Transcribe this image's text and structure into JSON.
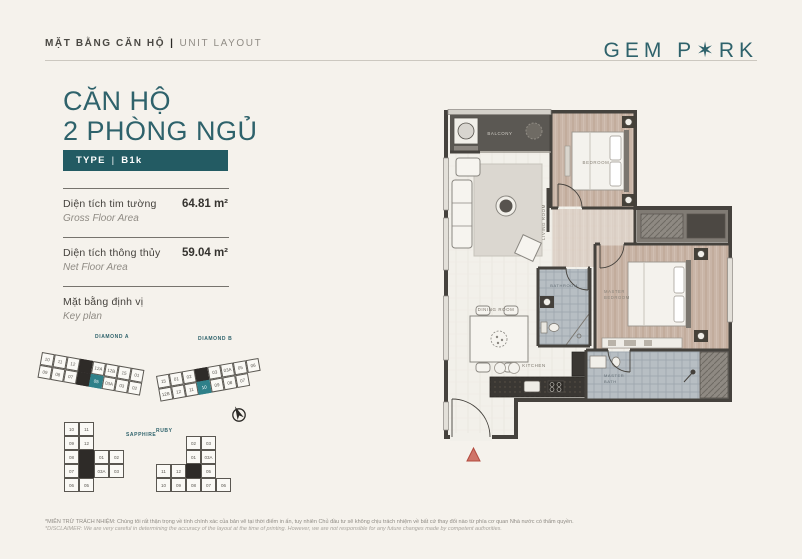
{
  "colors": {
    "accent": "#2e626b",
    "badge": "#235b63",
    "highlight": "#2f8089",
    "wall": "#45423d",
    "wood": "#c9b5a7",
    "tile": "#b7bec3",
    "entry_marker": "#cf7468"
  },
  "header": {
    "title_vi": "MẶT BẰNG CĂN HỘ",
    "sep": "|",
    "title_en": "UNIT LAYOUT",
    "logo_part1": "GEM P",
    "logo_star": "✶",
    "logo_part2": "RK"
  },
  "unit": {
    "title_line1": "CĂN HỘ",
    "title_line2": "2 PHÒNG NGỦ",
    "type_label": "TYPE",
    "type_sep": "|",
    "type_value": "B1k"
  },
  "areas": [
    {
      "label_vi": "Diện tích tim tường",
      "label_en": "Gross Floor Area",
      "value": "64.81 m²"
    },
    {
      "label_vi": "Diện tích thông thủy",
      "label_en": "Net Floor Area",
      "value": "59.04 m²"
    }
  ],
  "keyplan": {
    "label_vi": "Mặt bằng định vị",
    "label_en": "Key plan",
    "diamond_a": {
      "name": "DIAMOND A",
      "top": [
        "10",
        "11",
        "12",
        {
          "t": "",
          "c": "dk"
        },
        "12A",
        "12B",
        "15",
        "01"
      ],
      "bottom": [
        "09",
        "08",
        "07",
        {
          "t": "",
          "c": "dk"
        },
        {
          "t": "05",
          "c": "hl"
        },
        "03A",
        "03",
        "02"
      ]
    },
    "diamond_b": {
      "name": "DIAMOND B",
      "top": [
        "15",
        "01",
        "02",
        {
          "t": "",
          "c": "dk"
        },
        "03",
        "03A",
        "05",
        "06"
      ],
      "bottom": [
        "12B",
        "12",
        "11",
        {
          "t": "10",
          "c": "hl"
        },
        "09",
        "08",
        "07",
        {
          "t": "",
          "c": "empty"
        }
      ]
    },
    "sapphire": {
      "name": "SAPPHIRE",
      "cells": [
        "10",
        "11",
        {
          "t": "",
          "c": "empty"
        },
        {
          "t": "",
          "c": "empty"
        },
        "09",
        "12",
        {
          "t": "",
          "c": "empty"
        },
        {
          "t": "",
          "c": "empty"
        },
        "08",
        {
          "t": "",
          "c": "dk"
        },
        "01",
        "02",
        "07",
        {
          "t": "",
          "c": "dk"
        },
        "03A",
        "03",
        "06",
        "05",
        {
          "t": "",
          "c": "empty"
        },
        {
          "t": "",
          "c": "empty"
        }
      ]
    },
    "ruby": {
      "name": "RUBY",
      "cells": [
        {
          "t": "",
          "c": "empty"
        },
        {
          "t": "",
          "c": "empty"
        },
        "02",
        "03",
        {
          "t": "",
          "c": "empty"
        },
        {
          "t": "",
          "c": "empty"
        },
        {
          "t": "",
          "c": "empty"
        },
        "01",
        "03A",
        {
          "t": "",
          "c": "empty"
        },
        "11",
        "12",
        {
          "t": "",
          "c": "dk"
        },
        "05",
        {
          "t": "",
          "c": "empty"
        },
        "10",
        "09",
        "08",
        "07",
        "06"
      ]
    }
  },
  "floorplan": {
    "rooms": {
      "balcony": "BALCONY",
      "living": "LIVING ROOM",
      "bedroom": "BEDROOM",
      "dining": "DINING ROOM",
      "bathroom": "BATHROOM",
      "kitchen": "KITCHEN",
      "master_l1": "MASTER",
      "master_l2": "BEDROOM",
      "mbath_l1": "MASTER",
      "mbath_l2": "BATH"
    }
  },
  "footer": {
    "line1": "*MIỄN TRỪ TRÁCH NHIỆM: Chúng tôi rất thận trọng về tính chính xác của bản vẽ tại thời điểm in ấn, tuy nhiên Chủ đầu tư sẽ không chịu trách nhiệm về bất cứ thay đổi nào từ phía cơ quan Nhà nước có thẩm quyền.",
    "line2": "*DISCLAIMER: We are very careful in determining the accuracy of the layout at the time of printing. However, we are not responsible for any future changes made by competent authorities."
  }
}
